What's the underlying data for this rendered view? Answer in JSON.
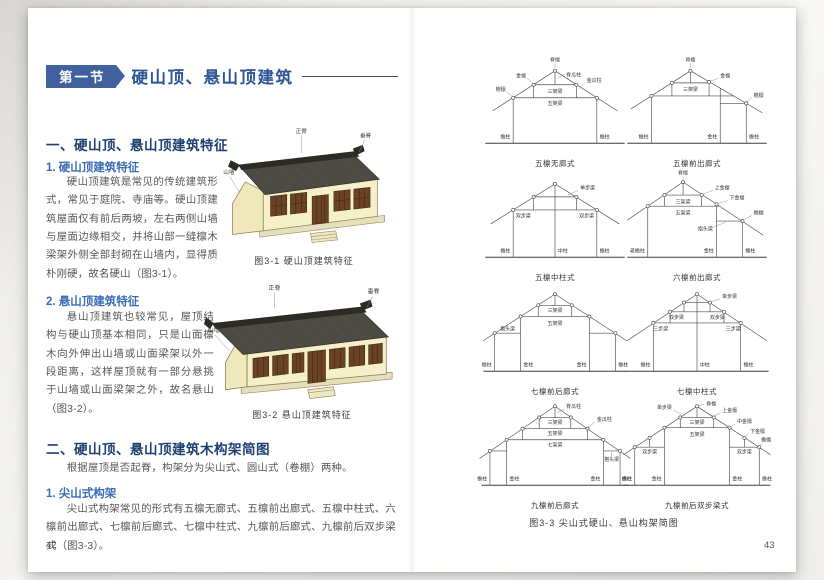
{
  "book": {
    "left_page": {
      "page_number": "42",
      "section_badge": "第一节",
      "section_title": "硬山顶、悬山顶建筑",
      "section1_heading": "一、硬山顶、悬山顶建筑特征",
      "sub1_heading": "1. 硬山顶建筑特征",
      "sub1_body": "硬山顶建筑是常见的传统建筑形式，常见于庭院、寺庙等。硬山顶建筑屋面仅有前后两坡，左右两侧山墙与屋面边缘相交，并将山部一缝檩木梁架外侧全部封砌在山墙内，显得质朴刚硬，故名硬山（图3-1）。",
      "fig1_caption": "图3-1 硬山顶建筑特征",
      "fig1_labels": {
        "ridge": "正脊",
        "vertical_ridge": "垂脊",
        "gable_wall": "山墙"
      },
      "sub2_heading": "2. 悬山顶建筑特征",
      "sub2_body": "悬山顶建筑也较常见，屋顶结构与硬山顶基本相同，只是山面檩木向外伸出山墙或山面梁架以外一段距离，这样屋顶就有一部分悬挑于山墙或山面梁架之外，故名悬山（图3-2）。",
      "fig2_caption": "图3-2 悬山顶建筑特征",
      "fig2_labels": {
        "ridge": "正脊",
        "vertical_ridge": "垂脊",
        "gable_wall": "山墙"
      },
      "section2_heading": "二、硬山顶、悬山顶建筑木构架简图",
      "section2_body": "根据屋顶是否起脊，构架分为尖山式、圆山式（卷棚）两种。",
      "sub3_heading": "1. 尖山式构架",
      "sub3_body": "尖山式构架常见的形式有五檩无廊式、五檩前出廊式、五檩中柱式、六檩前出廊式、七檩前后廊式、七檩中柱式、九檩前后廊式、九檩前后双步梁式（图3-3）。"
    },
    "right_page": {
      "page_number": "43",
      "figure_caption": "图3-3 尖山式硬山、悬山构架简图",
      "diagrams": [
        {
          "caption": "五檩无廊式",
          "labels": {
            "jilin": "脊檩",
            "jiguazhu": "脊瓜柱",
            "jinlin": "金檩",
            "yanlin": "檐檩",
            "sanjialiang": "三架梁",
            "wujialiang": "五架梁",
            "jinguazhu": "金瓜柱",
            "yanzhu_l": "檐柱",
            "yanzhu_r": "檐柱"
          }
        },
        {
          "caption": "五檩前出廊式",
          "labels": {
            "jilin": "脊檩",
            "jinlin": "金檩",
            "yanlin": "檐檩",
            "sanjialiang": "三架梁",
            "yanzhu_l": "檐柱",
            "jinzhu": "金柱",
            "yanzhu_r": "檐柱"
          }
        },
        {
          "caption": "五檩中柱式",
          "labels": {
            "danbuliang": "单步梁",
            "shuangbuliang_l": "双步梁",
            "shuangbuliang_r": "双步梁",
            "yanzhu_l": "檐柱",
            "zhongzhu": "中柱",
            "yanzhu_r": "檐柱"
          }
        },
        {
          "caption": "六檩前出廊式",
          "labels": {
            "jilin": "脊檩",
            "shangjinlin": "上金檩",
            "xiajinlin": "下金檩",
            "yanlin": "檐檩",
            "sanjialiang": "三架梁",
            "wujialiang": "五架梁",
            "baotouliang": "抱头梁",
            "laoyanzhu": "老檐柱",
            "jinzhu": "金柱",
            "yanzhu": "檐柱"
          }
        },
        {
          "caption": "七檩前后廊式",
          "labels": {
            "sanjialiang": "三架梁",
            "wujialiang": "五架梁",
            "baotouliang": "抱头梁",
            "yanzhu_l": "檐柱",
            "jinzhu_l": "金柱",
            "jinzhu_r": "金柱",
            "yanzhu_r": "檐柱"
          }
        },
        {
          "caption": "七檩中柱式",
          "labels": {
            "danbuliang": "单步梁",
            "shuangbuliang_l": "双步梁",
            "shuangbuliang_r": "双步梁",
            "sanbuliang_l": "三步梁",
            "sanbuliang_r": "三步梁",
            "yanzhu_l": "檐柱",
            "zhongzhu": "中柱",
            "yanzhu_r": "檐柱"
          }
        },
        {
          "caption": "九檩前后廊式",
          "labels": {
            "jiguazhu": "脊瓜柱",
            "jinguazhu": "金瓜柱",
            "sanjialiang": "三架梁",
            "wujialiang": "五架梁",
            "qijialiang": "七架梁",
            "baotouliang": "抱头梁",
            "yanzhu_l": "檐柱",
            "jinzhu_l": "金柱",
            "jinzhu_r": "金柱",
            "yanzhu_r": "檐柱"
          }
        },
        {
          "caption": "九檩前后双步梁式",
          "labels": {
            "jilin": "脊檩",
            "danbuliang": "单步梁",
            "shangjinlin": "上金檩",
            "zhongjinlin": "中金檩",
            "xiajinlin": "下金檩",
            "yanlin": "檐檩",
            "sanjialiang": "三架梁",
            "wujialiang": "五架梁",
            "shuangbuliang_l": "双步梁",
            "shuangbuliang_r": "双步梁",
            "yanzhu_l": "檐柱",
            "jinzhu_l": "金柱",
            "jinzhu_r": "金柱",
            "yanzhu_r": "檐柱"
          }
        }
      ]
    },
    "colors": {
      "badge_blue": "#41619e",
      "title_blue": "#2d5496",
      "heading_navy": "#1e3f71",
      "sub_blue": "#3a6cb5",
      "body_gray": "#57575a",
      "roof_dark": "#4b4a43",
      "wall_cream": "#f6f0ca",
      "wood_brown": "#6b4226"
    }
  }
}
